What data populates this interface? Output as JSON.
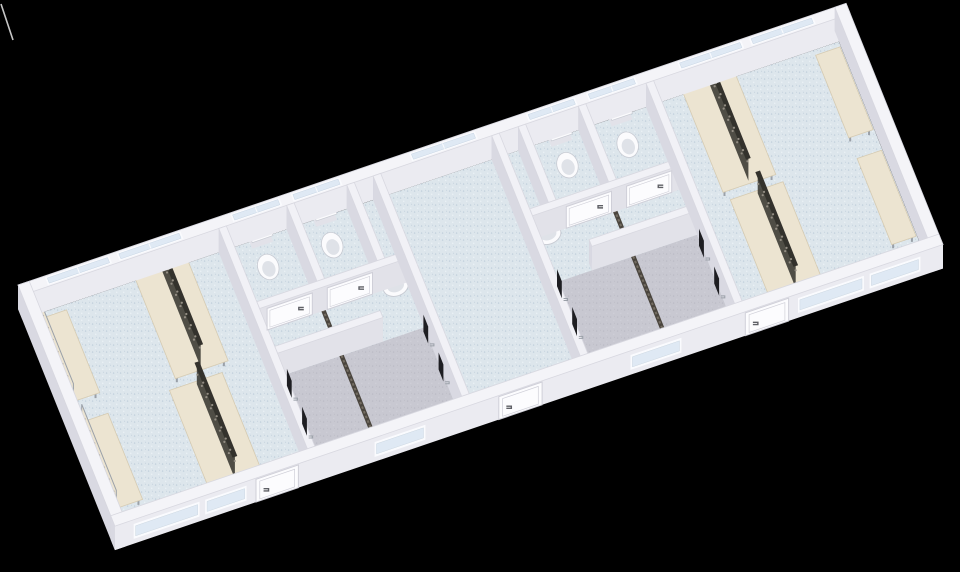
{
  "meta": {
    "description": "3D rendered floor plan of a modular changing room building with two changing rooms, two sanitary cores with toilets and showers, and a central hall",
    "background": "#000000"
  },
  "projection": {
    "canvas": [
      960,
      572
    ],
    "origin": [
      18,
      309
    ],
    "ux": [
      0.941,
      -0.32
    ],
    "vy": [
      0.346,
      0.861
    ],
    "wall_height": 24,
    "axis_angle_deg": -18.8
  },
  "colors": {
    "bg": "#000000",
    "wallTopExt": "#f4f4f8",
    "wallTopInt": "#f1f1f6",
    "wallEdge": "#d8d8e0",
    "faceExt": "#ebebf1",
    "faceSouth": "#e2e2e9",
    "faceSide": "#d9d9e2",
    "faceNorth": "#cfcfd8",
    "floorBlue": "#dde6ec",
    "floorBlueDot1": "#bfcedb",
    "floorBlueDot2": "#f2f7fa",
    "floorGray": "#c8c8d1",
    "floorGrayDot": "#babac4",
    "windowFill": "#dfe9f4",
    "windowFrame": "#fafbfe",
    "doorFill": "#fcfcfe",
    "doorFrame": "#cfcfd8",
    "handle": "#5f6066",
    "fixture": "#fbfbfd",
    "fixtureShade": "#dfe2e8",
    "fixtureEdge": "#c7cad2",
    "bench": "#ece4d1",
    "benchEdge": "#d6cbb2",
    "metal": "#9aa0a8",
    "rack": "#34322d",
    "rackHook": "#938d83",
    "drain": "#4a453e",
    "drainDash": "#746d62",
    "panel": "#1e1e22",
    "artifact": "#dcdcdc"
  },
  "plan": {
    "length": 880,
    "depth": 280,
    "slab": {
      "x": 12,
      "y": 12,
      "w": 856,
      "h": 256
    }
  },
  "shower_floors": [
    {
      "name": "shower-room-left",
      "x": 217,
      "y": 160,
      "w": 156,
      "h": 108
    },
    {
      "name": "shower-room-right",
      "x": 507,
      "y": 160,
      "w": 156,
      "h": 108
    }
  ],
  "walls": [
    {
      "name": "back-exterior-wall",
      "x": 0,
      "y": 0,
      "w": 880,
      "h": 12,
      "ext": true
    },
    {
      "name": "left-end-exterior-wall",
      "x": 0,
      "y": 0,
      "w": 12,
      "h": 280,
      "ext": true
    },
    {
      "name": "right-end-exterior-wall",
      "x": 868,
      "y": 0,
      "w": 12,
      "h": 280,
      "ext": true
    },
    {
      "name": "wall-changing-left-east",
      "x": 209,
      "y": 12,
      "w": 8,
      "h": 256
    },
    {
      "name": "wall-stall-partition-left",
      "x": 281,
      "y": 12,
      "w": 8,
      "h": 88
    },
    {
      "name": "wall-sink-nook-left",
      "x": 345,
      "y": 12,
      "w": 8,
      "h": 88
    },
    {
      "name": "wall-hall-west",
      "x": 373,
      "y": 12,
      "w": 8,
      "h": 256
    },
    {
      "name": "wall-hall-east",
      "x": 499,
      "y": 12,
      "w": 8,
      "h": 256
    },
    {
      "name": "wall-sink-nook-right",
      "x": 527,
      "y": 12,
      "w": 8,
      "h": 88
    },
    {
      "name": "wall-stall-partition-right",
      "x": 591,
      "y": 12,
      "w": 8,
      "h": 88
    },
    {
      "name": "wall-changing-right-west",
      "x": 663,
      "y": 12,
      "w": 8,
      "h": 256
    },
    {
      "name": "wall-stall-front-left",
      "x": 217,
      "y": 100,
      "w": 156,
      "h": 8
    },
    {
      "name": "wall-shower-divider-left",
      "x": 217,
      "y": 152,
      "w": 112,
      "h": 8
    },
    {
      "name": "wall-stall-front-right",
      "x": 507,
      "y": 100,
      "w": 156,
      "h": 8
    },
    {
      "name": "wall-shower-divider-right",
      "x": 551,
      "y": 152,
      "w": 112,
      "h": 8
    },
    {
      "name": "front-exterior-wall",
      "x": 0,
      "y": 268,
      "w": 880,
      "h": 12,
      "ext": true
    }
  ],
  "back_windows": [
    {
      "x": 28,
      "w": 68
    },
    {
      "x": 104,
      "w": 68
    },
    {
      "x": 225,
      "w": 52
    },
    {
      "x": 289,
      "w": 52
    },
    {
      "x": 415,
      "w": 70
    },
    {
      "x": 539,
      "w": 52
    },
    {
      "x": 603,
      "w": 52
    },
    {
      "x": 700,
      "w": 68
    },
    {
      "x": 776,
      "w": 68
    }
  ],
  "face_windows": [
    {
      "x": 20,
      "w": 70
    },
    {
      "x": 96,
      "w": 44
    },
    {
      "x": 276,
      "w": 54
    },
    {
      "x": 548,
      "w": 54
    },
    {
      "x": 726,
      "w": 70
    },
    {
      "x": 802,
      "w": 54
    }
  ],
  "face_doors": [
    {
      "name": "entrance-door-left",
      "x": 150,
      "w": 45
    },
    {
      "name": "entrance-door-middle",
      "x": 408,
      "w": 46
    },
    {
      "name": "entrance-door-right",
      "x": 670,
      "w": 46
    }
  ],
  "stall_doors": [
    {
      "name": "toilet-stall-door",
      "x": 225,
      "w": 48
    },
    {
      "name": "toilet-stall-door",
      "x": 289,
      "w": 48
    },
    {
      "name": "toilet-stall-door",
      "x": 543,
      "w": 48
    },
    {
      "name": "toilet-stall-door",
      "x": 607,
      "w": 48
    }
  ],
  "toilets": [
    {
      "x": 249,
      "y": 38
    },
    {
      "x": 317,
      "y": 38
    },
    {
      "x": 567,
      "y": 38
    },
    {
      "x": 631,
      "y": 38
    }
  ],
  "sinks": [
    {
      "x": 358,
      "y": 118,
      "facing": "east"
    },
    {
      "x": 520,
      "y": 118,
      "facing": "west"
    }
  ],
  "shower_panels": [
    {
      "x": 221,
      "y": 176
    },
    {
      "x": 221,
      "y": 220
    },
    {
      "x": 369,
      "y": 168
    },
    {
      "x": 369,
      "y": 212
    },
    {
      "x": 511,
      "y": 168
    },
    {
      "x": 511,
      "y": 212
    },
    {
      "x": 659,
      "y": 176
    },
    {
      "x": 659,
      "y": 220
    }
  ],
  "drains": [
    {
      "x": 285,
      "y1": 106,
      "y2": 262
    },
    {
      "x": 595,
      "y1": 106,
      "y2": 262
    }
  ],
  "benches_wall": [
    {
      "x": 16,
      "y": 26,
      "w": 26,
      "h": 96,
      "rail": "west"
    },
    {
      "x": 16,
      "y": 146,
      "w": 26,
      "h": 100,
      "rail": "west"
    },
    {
      "x": 838,
      "y": 26,
      "w": 26,
      "h": 96,
      "rail": "east"
    },
    {
      "x": 838,
      "y": 146,
      "w": 26,
      "h": 100,
      "rail": "east"
    }
  ],
  "benches_island": [
    {
      "x": 118,
      "y": 16,
      "w": 56,
      "h": 118
    },
    {
      "x": 108,
      "y": 144,
      "w": 56,
      "h": 116
    },
    {
      "x": 700,
      "y": 16,
      "w": 56,
      "h": 118
    },
    {
      "x": 704,
      "y": 144,
      "w": 56,
      "h": 116
    }
  ],
  "artifact_polyline": [
    [
      1,
      4
    ],
    [
      6,
      19
    ],
    [
      13,
      40
    ]
  ]
}
